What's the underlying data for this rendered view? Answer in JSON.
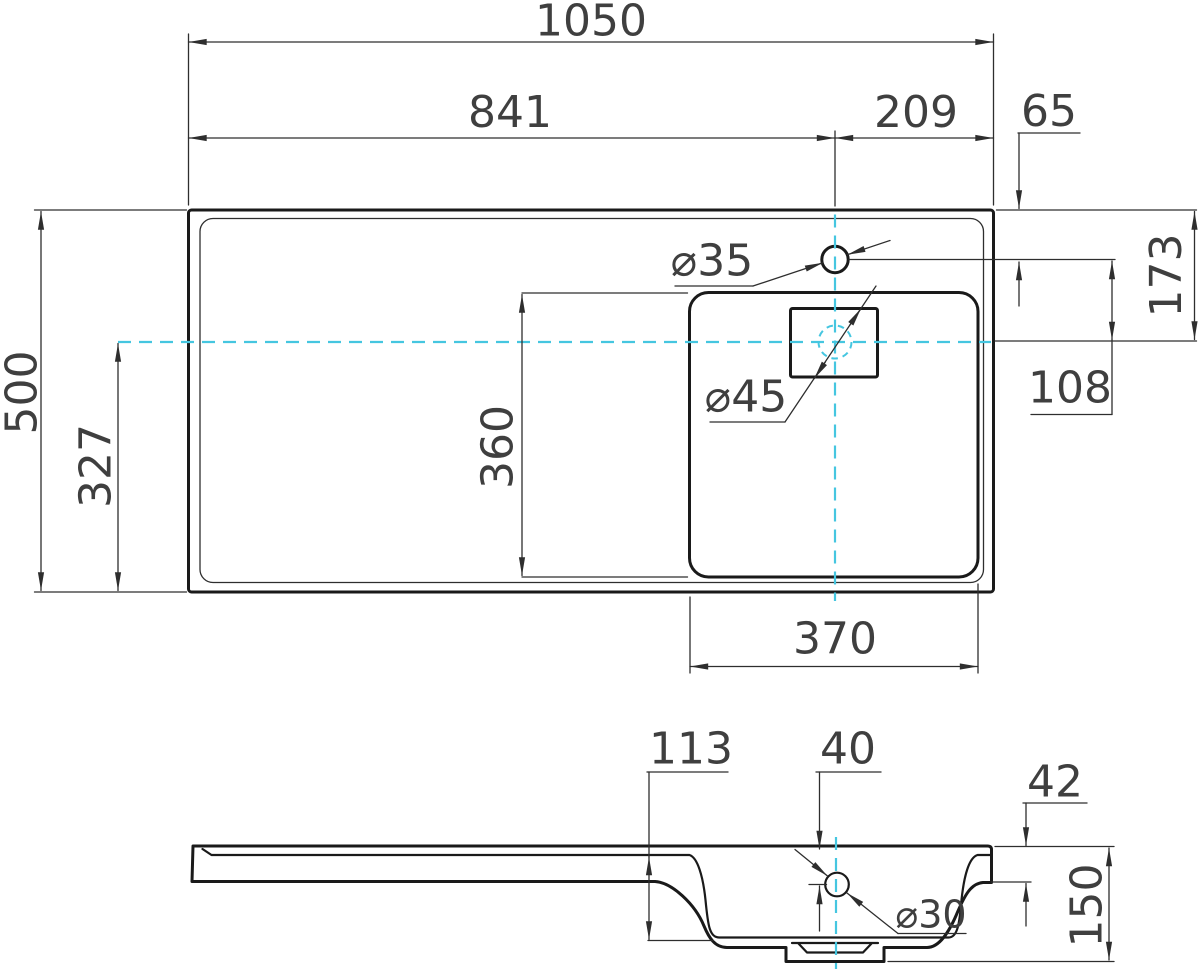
{
  "colors": {
    "ink": "#1a1a1a",
    "dim": "#2e2e2e",
    "text": "#3f3f3f",
    "centerline": "#45c6e0",
    "background": "#ffffff"
  },
  "top_view": {
    "dimensions": {
      "overall_width": "1050",
      "faucet_axis_from_left": "841",
      "faucet_axis_from_right": "209",
      "faucet_offset_from_back": "65",
      "overall_depth": "500",
      "drain_axis_from_front": "327",
      "basin_inner_length": "360",
      "basin_inner_width": "370",
      "drain_axis_from_back": "173",
      "faucet_to_drain_axis": "108",
      "faucet_hole_diameter": "⌀35",
      "drain_hole_diameter": "⌀45"
    }
  },
  "side_view": {
    "dimensions": {
      "basin_depth": "113",
      "overflow_center_from_top": "40",
      "deck_thickness": "42",
      "overall_height": "150",
      "overflow_hole_diameter": "⌀30"
    }
  }
}
